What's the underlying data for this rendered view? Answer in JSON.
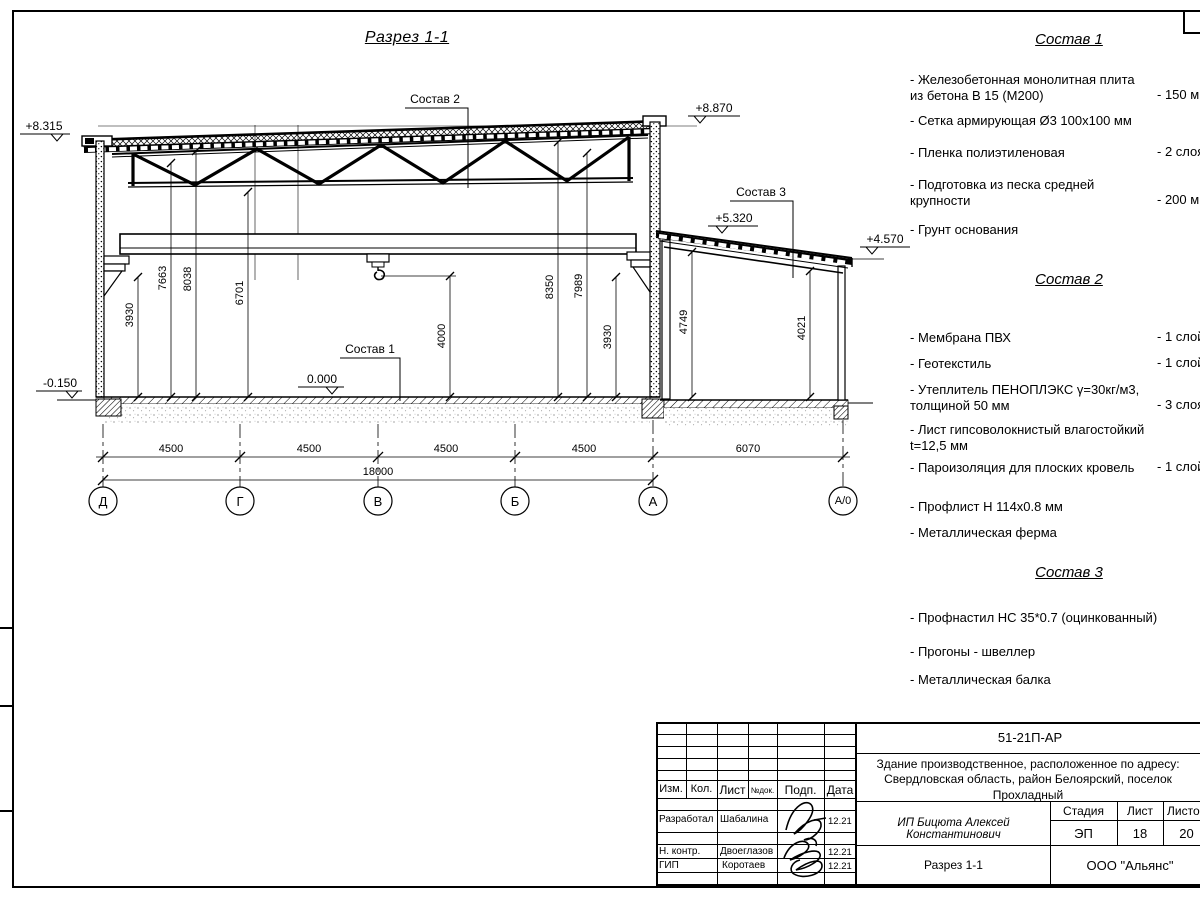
{
  "drawing": {
    "title": "Разрез 1-1",
    "labels": {
      "sostav1": "Состав 1",
      "sostav2": "Состав 2",
      "sostav3": "Состав 3"
    },
    "elevations": {
      "roof_left": "+8.315",
      "roof_right": "+8.870",
      "annex_high": "+5.320",
      "annex_low": "+4.570",
      "ground": "-0.150",
      "floor": "0.000"
    },
    "vdims": {
      "d1": "3930",
      "d2": "7663",
      "d3": "8038",
      "d4": "6701",
      "d5": "4000",
      "d6": "8350",
      "d7": "7989",
      "d8": "3930",
      "d9": "4749",
      "d10": "4021"
    },
    "hdims": {
      "s1": "4500",
      "s2": "4500",
      "s3": "4500",
      "s4": "4500",
      "s5": "6070",
      "total": "18000"
    },
    "axes": {
      "a1": "Д",
      "a2": "Г",
      "a3": "В",
      "a4": "Б",
      "a5": "А",
      "a6": "А/0"
    }
  },
  "sostav1": {
    "title": "Состав 1",
    "items": [
      {
        "name": "- Железобетонная  монолитная плита из бетона В 15 (М200)",
        "qty": "- 150 мм"
      },
      {
        "name": "- Сетка армирующая Ø3 100х100 мм",
        "qty": ""
      },
      {
        "name": "- Пленка полиэтиленовая",
        "qty": "-  2 слоя"
      },
      {
        "name": "- Подготовка из песка средней крупности",
        "qty": "- 200 мм"
      },
      {
        "name": "- Грунт основания",
        "qty": ""
      }
    ]
  },
  "sostav2": {
    "title": "Состав 2",
    "items": [
      {
        "name": "- Мембрана ПВХ",
        "qty": "- 1 слой"
      },
      {
        "name": "- Геотекстиль",
        "qty": "- 1 слой"
      },
      {
        "name": "- Утеплитель ПЕНОПЛЭКС γ=30кг/м3, толщиной 50 мм",
        "qty": "- 3 слоя"
      },
      {
        "name": "- Лист гипсоволокнистый влагостойкий t=12,5 мм",
        "qty": ""
      },
      {
        "name": "- Пароизоляция для плоских кровель",
        "qty": "- 1 слой"
      },
      {
        "name": "- Профлист Н 114х0.8 мм",
        "qty": ""
      },
      {
        "name": "- Металлическая ферма",
        "qty": ""
      }
    ]
  },
  "sostav3": {
    "title": "Состав 3",
    "items": [
      {
        "name": "- Профнастил НС 35*0.7 (оцинкованный)",
        "qty": ""
      },
      {
        "name": "- Прогоны - швеллер",
        "qty": ""
      },
      {
        "name": "- Металлическая балка",
        "qty": ""
      }
    ]
  },
  "titleblock": {
    "code": "51-21П-АР",
    "object": "Здание производственное, расположенное по адресу: Свердловская область, район Белоярский, поселок Прохладный",
    "designer": "ИП Бицюта Алексей Константинович",
    "stage_label": "Стадия",
    "sheet_label": "Лист",
    "sheets_label": "Листов",
    "stage": "ЭП",
    "sheet": "18",
    "sheets": "20",
    "sheet_title": "Разрез 1-1",
    "org": "ООО \"Альянс\"",
    "head": {
      "izm": "Изм.",
      "kol": "Кол.",
      "list": "Лист",
      "ndok": "№док.",
      "podp": "Подп.",
      "data": "Дата"
    },
    "rows": [
      {
        "role": "Разработал",
        "name": "Шабалина",
        "date": "12.21"
      },
      {
        "role": "Н. контр.",
        "name": "Двоеглазов",
        "date": "12.21"
      },
      {
        "role": "ГИП",
        "name": "Коротаев",
        "date": "12.21"
      }
    ]
  }
}
